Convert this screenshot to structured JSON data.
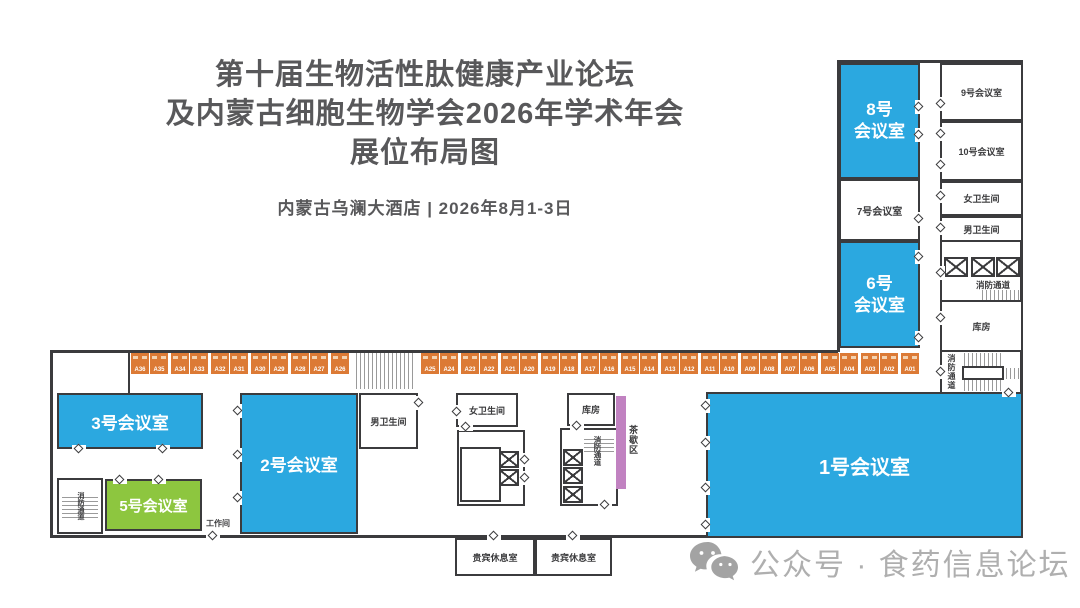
{
  "title": {
    "line1": "第十届生物活性肽健康产业论坛",
    "line2": "及内蒙古细胞生物学会2026年学术年会",
    "line3": "展位布局图",
    "subtitle": "内蒙古乌澜大酒店 | 2026年8月1-3日"
  },
  "rooms": {
    "r1": {
      "label": "1号会议室"
    },
    "r2": {
      "label": "2号会议室"
    },
    "r3": {
      "label": "3号会议室"
    },
    "r5": {
      "label": "5号会议室"
    },
    "r6": {
      "line1": "6号",
      "line2": "会议室"
    },
    "r7": {
      "label": "7号会议室"
    },
    "r8": {
      "line1": "8号",
      "line2": "会议室"
    },
    "r9": {
      "label": "9号会议室"
    },
    "r10": {
      "label": "10号会议室"
    },
    "womens_top": {
      "label": "女卫生间"
    },
    "mens_top": {
      "label": "男卫生间"
    },
    "womens_mid": {
      "label": "女卫生间"
    },
    "mens_mid": {
      "label": "男卫生间"
    },
    "storage_top": {
      "label": "库房"
    },
    "storage_mid": {
      "label": "库房"
    },
    "vip1": {
      "label": "贵宾休息室"
    },
    "vip2": {
      "label": "贵宾休息室"
    },
    "workroom": {
      "label": "工作间"
    },
    "tea_area": {
      "label": "茶歇区"
    },
    "fire_escape": {
      "label": "消防通道"
    }
  },
  "booths": {
    "left": [
      "A36",
      "A35",
      "A34",
      "A33",
      "A32",
      "A31",
      "A30",
      "A29",
      "A28",
      "A27",
      "A26"
    ],
    "right": [
      "A25",
      "A24",
      "A23",
      "A22",
      "A21",
      "A20",
      "A19",
      "A18",
      "A17",
      "A16",
      "A15",
      "A14",
      "A13",
      "A12",
      "A11",
      "A10",
      "A09",
      "A08",
      "A07",
      "A06",
      "A05",
      "A04",
      "A03",
      "A02",
      "A01"
    ]
  },
  "footer": {
    "text": "公众号 · 食药信息论坛"
  },
  "colors": {
    "room-blue": "#2BA8E0",
    "room-green": "#8DC63F",
    "booth-orange": "#DC7A35",
    "tea-purple": "#C182C1",
    "wall": "#3B3B3D",
    "title-ink": "#58585A",
    "footer-ink": "#AFAFAF"
  }
}
